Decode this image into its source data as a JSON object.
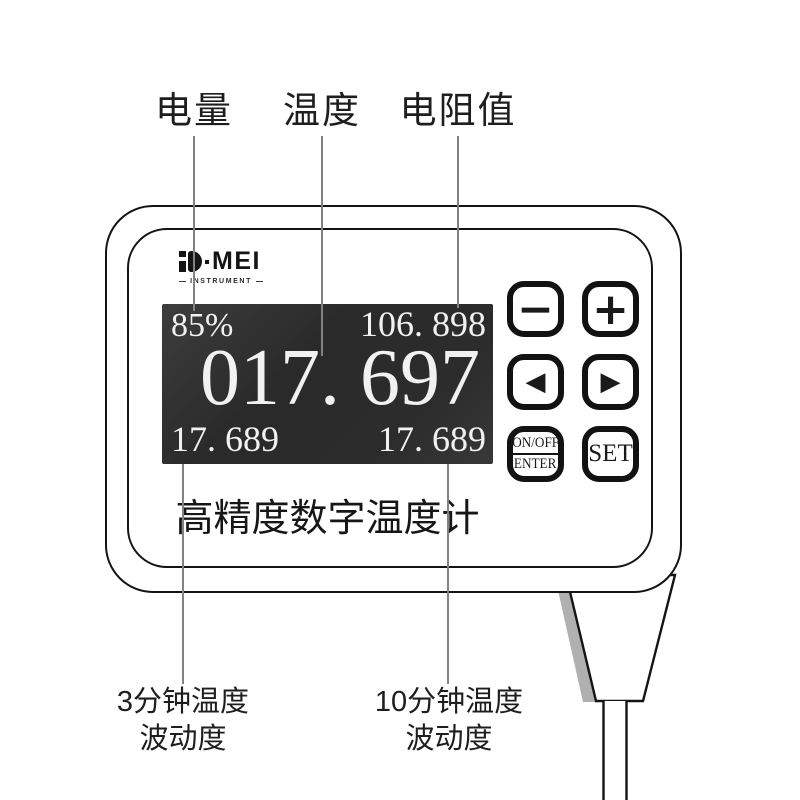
{
  "annotations": {
    "top_labels": [
      {
        "text": "电量"
      },
      {
        "text": "温度"
      },
      {
        "text": "电阻值"
      }
    ],
    "bottom_labels": [
      {
        "line1": "3分钟温度",
        "line2": "波动度"
      },
      {
        "line1": "10分钟温度",
        "line2": "波动度"
      }
    ]
  },
  "device": {
    "brand": {
      "letters": "MEI",
      "tagline": "INSTRUMENT"
    },
    "screen": {
      "battery": "85%",
      "resistance": "106. 898",
      "temperature": "017. 697",
      "fluctuation_3min": "17. 689",
      "fluctuation_10min": "17. 689"
    },
    "buttons": {
      "minus": "−",
      "plus": "+",
      "left": "◀",
      "right": "▶",
      "power_top": "ON/OFF",
      "power_bottom": "ENTER",
      "set": "SET"
    },
    "label": "高精度数字温度计"
  },
  "colors": {
    "outline": "#141414",
    "screen_bg": "#2c2c2c",
    "screen_text": "#f1f1f1",
    "callout_line": "#828282",
    "cable_shadow": "#b0b0b0",
    "background": "#ffffff"
  }
}
